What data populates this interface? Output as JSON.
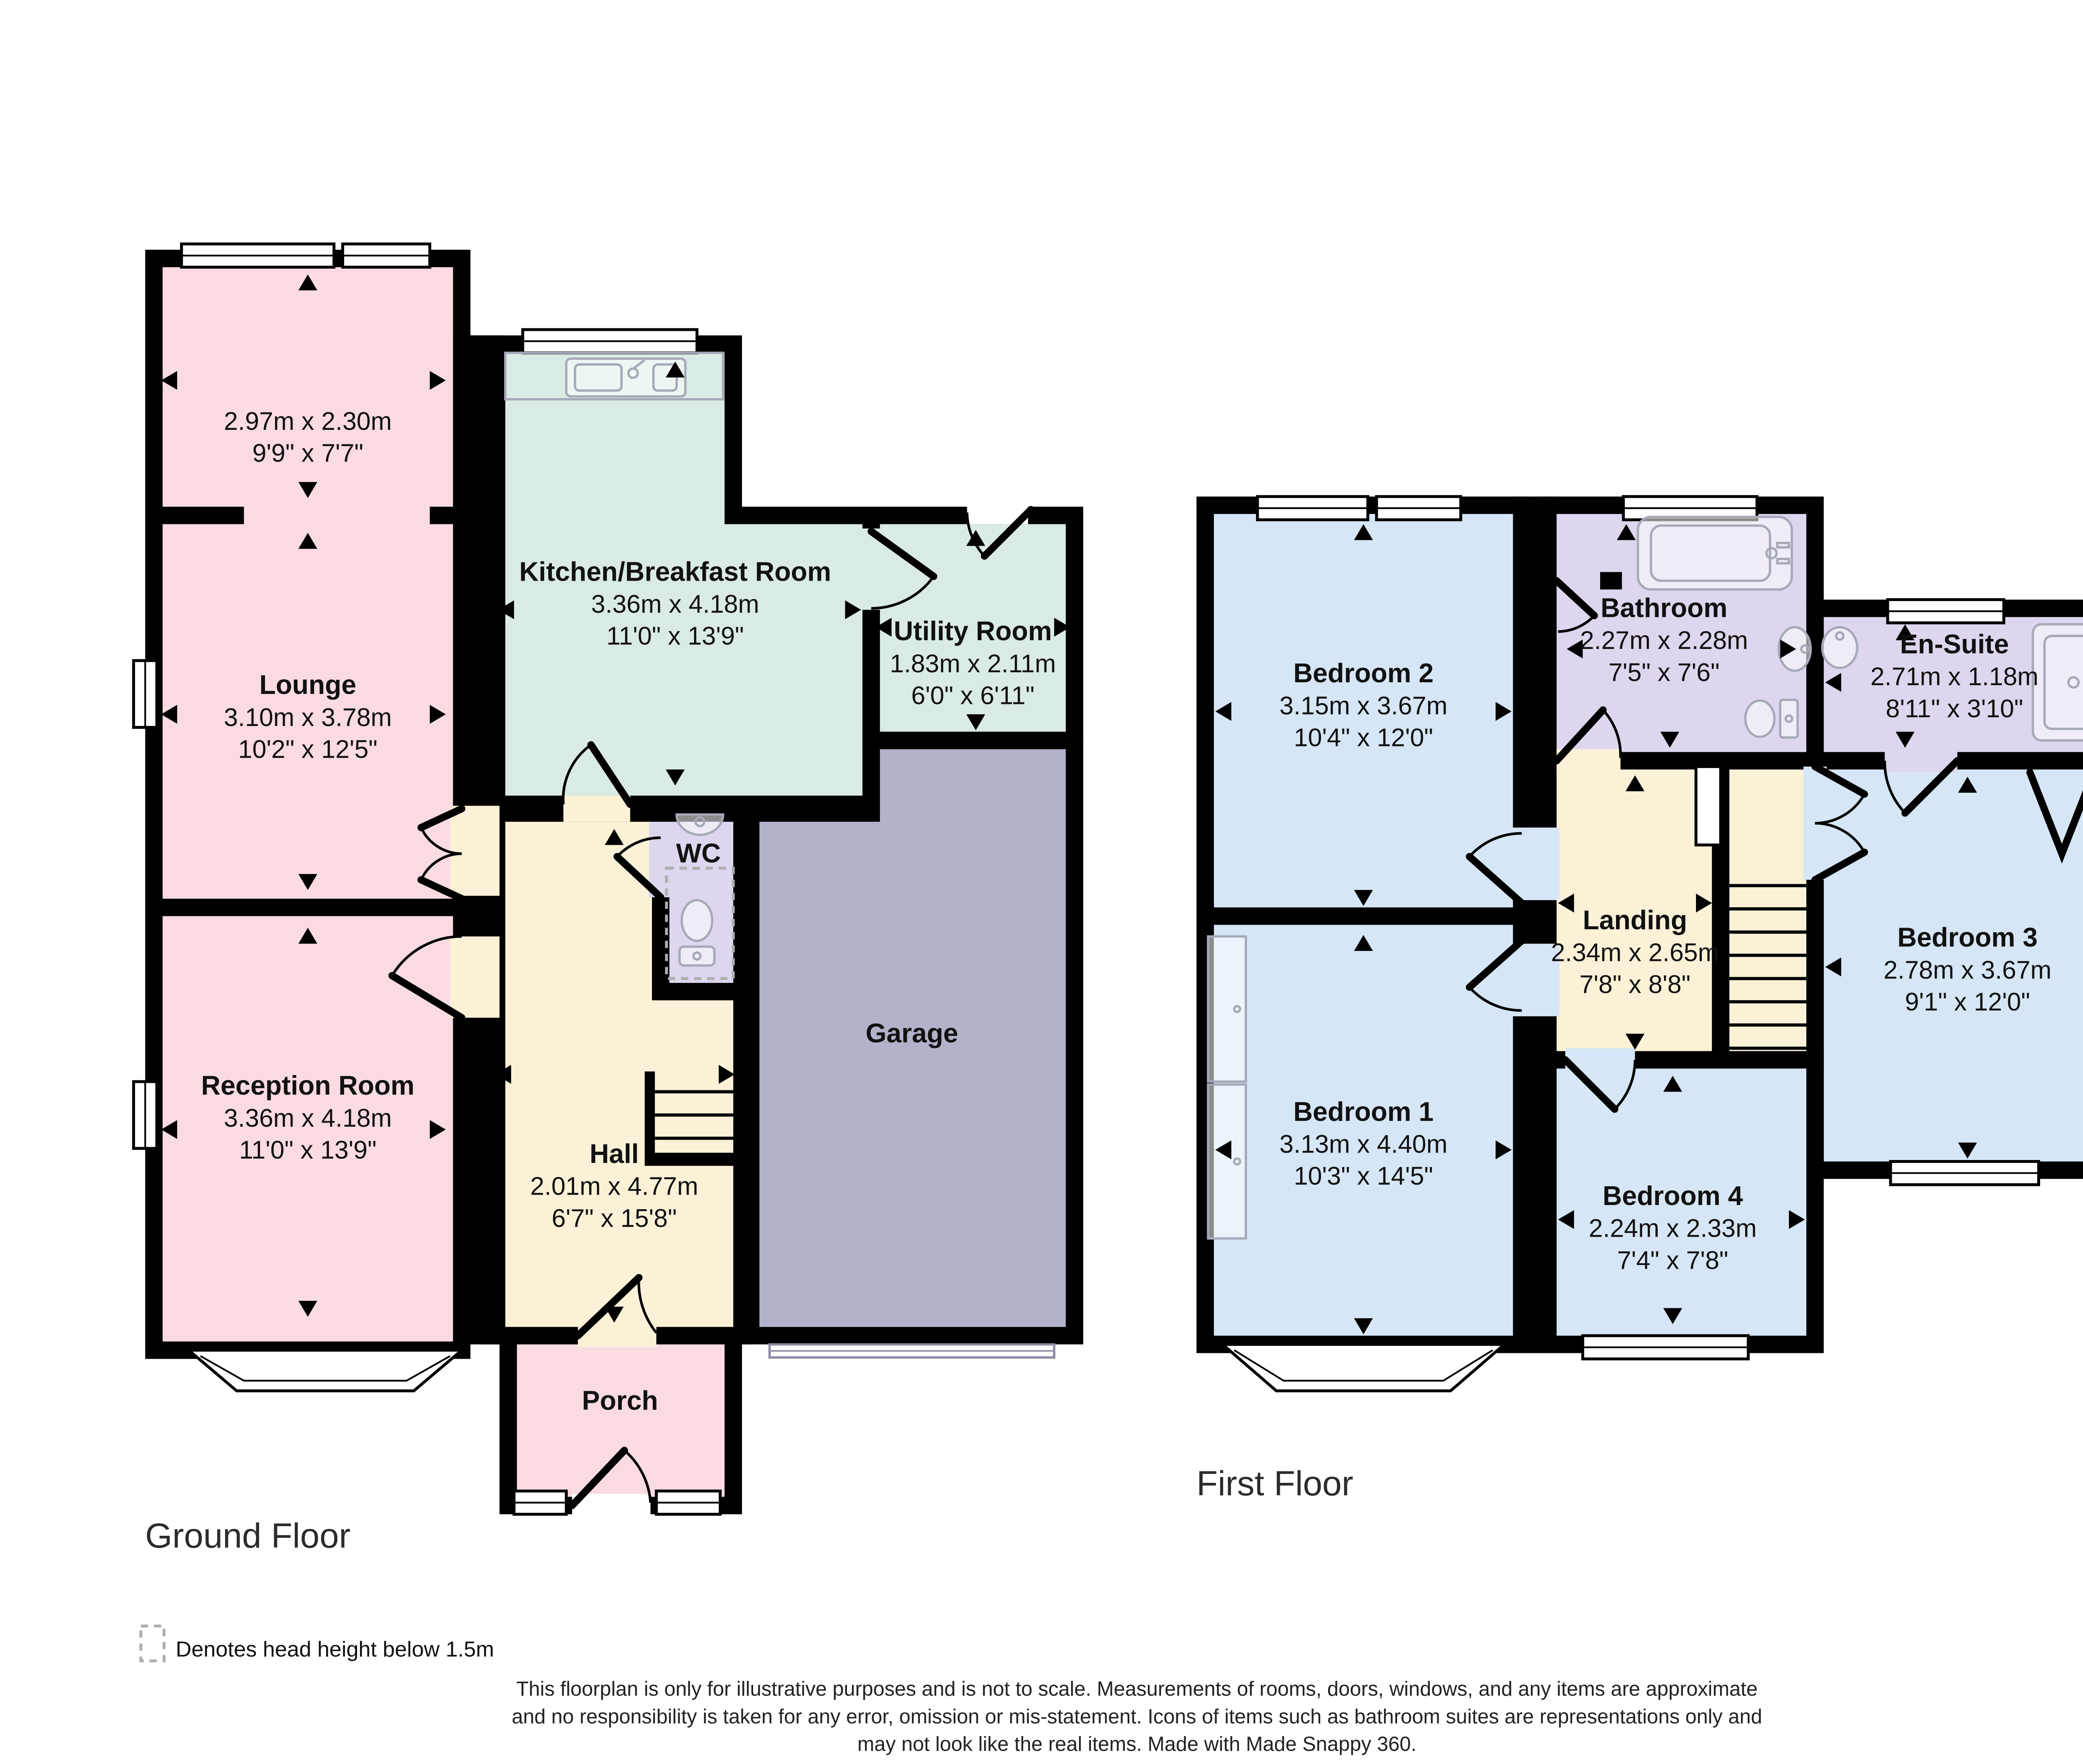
{
  "floors": {
    "ground": {
      "label": "Ground Floor"
    },
    "first": {
      "label": "First Floor"
    }
  },
  "rooms": {
    "front_room": {
      "metric": "2.97m x 2.30m",
      "imperial": "9'9\" x 7'7\""
    },
    "lounge": {
      "name": "Lounge",
      "metric": "3.10m x 3.78m",
      "imperial": "10'2\" x 12'5\""
    },
    "kitchen": {
      "name": "Kitchen/Breakfast Room",
      "metric": "3.36m x 4.18m",
      "imperial": "11'0\" x 13'9\""
    },
    "utility": {
      "name": "Utility Room",
      "metric": "1.83m x 2.11m",
      "imperial": "6'0\" x 6'11\""
    },
    "wc": {
      "name": "WC"
    },
    "garage": {
      "name": "Garage"
    },
    "reception": {
      "name": "Reception Room",
      "metric": "3.36m x 4.18m",
      "imperial": "11'0\" x 13'9\""
    },
    "hall": {
      "name": "Hall",
      "metric": "2.01m x 4.77m",
      "imperial": "6'7\" x 15'8\""
    },
    "porch": {
      "name": "Porch"
    },
    "bedroom2": {
      "name": "Bedroom 2",
      "metric": "3.15m x 3.67m",
      "imperial": "10'4\" x 12'0\""
    },
    "bathroom": {
      "name": "Bathroom",
      "metric": "2.27m x 2.28m",
      "imperial": "7'5\" x 7'6\""
    },
    "ensuite": {
      "name": "En-Suite",
      "metric": "2.71m x 1.18m",
      "imperial": "8'11\" x 3'10\""
    },
    "landing": {
      "name": "Landing",
      "metric": "2.34m x 2.65m",
      "imperial": "7'8\" x 8'8\""
    },
    "bedroom3": {
      "name": "Bedroom 3",
      "metric": "2.78m x 3.67m",
      "imperial": "9'1\" x 12'0\""
    },
    "bedroom1": {
      "name": "Bedroom 1",
      "metric": "3.13m x 4.40m",
      "imperial": "10'3\" x 14'5\""
    },
    "bedroom4": {
      "name": "Bedroom 4",
      "metric": "2.24m x 2.33m",
      "imperial": "7'4\" x 7'8\""
    }
  },
  "legend": {
    "label": "Denotes head height below 1.5m"
  },
  "footer": {
    "line1": "This floorplan is only for illustrative purposes and is not to scale. Measurements of rooms, doors, windows, and any items are approximate",
    "line2": "and no responsibility is taken for any error, omission or mis-statement. Icons of items such as bathroom suites are representations only and",
    "line3": "may not look like the real items. Made with Made Snappy 360."
  },
  "colors": {
    "pink": "#FADBE2",
    "teal": "#DAEAE5",
    "lavender": "#DDD6EE",
    "garage": "#B2B2CB",
    "cream": "#FAF1D7",
    "blue": "#D6E6F6",
    "wall": "#000000",
    "fixture": "#A6A9B8",
    "dashed": "#ADADAD"
  }
}
